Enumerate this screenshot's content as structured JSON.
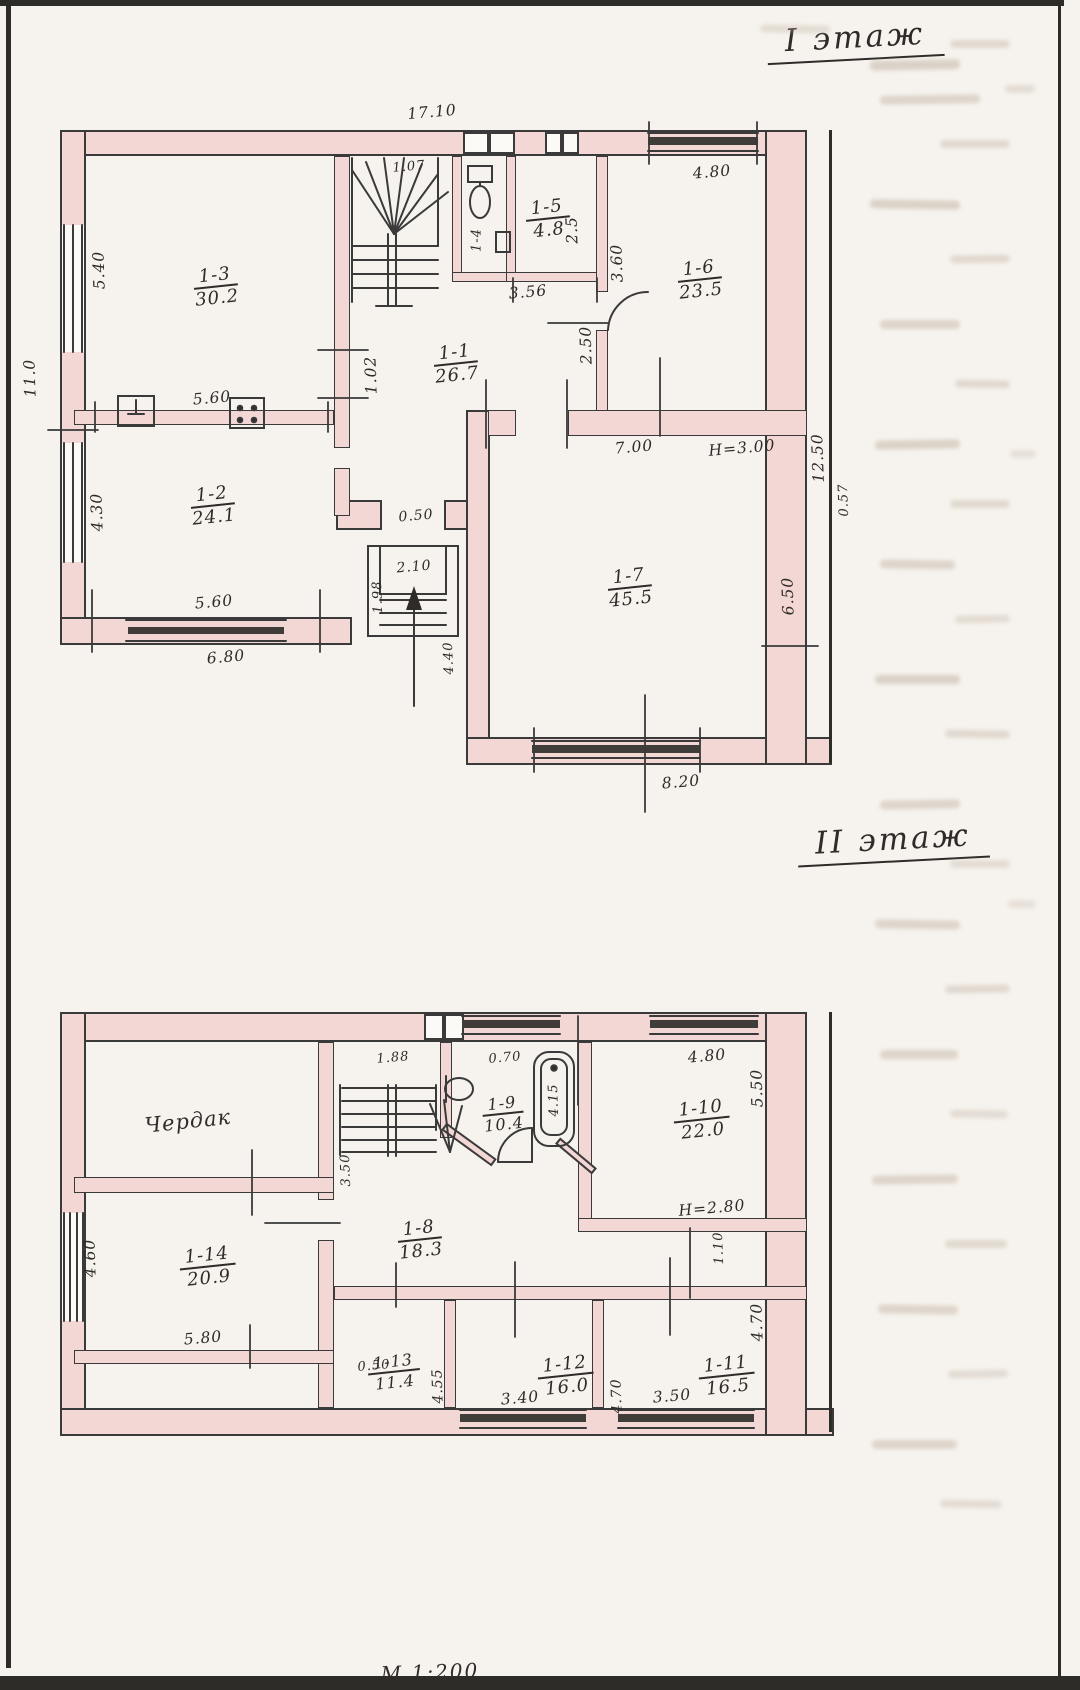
{
  "document": {
    "floor1_title": "I этаж",
    "floor2_title": "II этаж",
    "scale_note": "М 1:200"
  },
  "colors": {
    "paper": "#f6f3ee",
    "ink": "#2e2b28",
    "wall_line": "#3a3a3a",
    "wall_fill": "#f2d7d5",
    "window_dark": "#3f3c39",
    "frame": "#2e2c29"
  },
  "floor1": {
    "rooms": [
      {
        "id": "1-3",
        "area": "30.2"
      },
      {
        "id": "1-2",
        "area": "24.1"
      },
      {
        "id": "1-1",
        "area": "26.7"
      },
      {
        "id": "1-4"
      },
      {
        "id": "1-5",
        "area": "4.8"
      },
      {
        "id": "1-6",
        "area": "23.5"
      },
      {
        "id": "1-7",
        "area": "45.5"
      }
    ],
    "dims": {
      "top_width": "17.10",
      "left_height": "11.0",
      "r3_left": "5.40",
      "r3_bottom": "5.60",
      "r2_left": "4.30",
      "r2_bottom": "5.60",
      "outer_bottom_left": "6.80",
      "hall_left": "1.02",
      "stair_width": "1.07",
      "bath_bottom": "3.56",
      "r6_left_upper": "3.60",
      "r6_left_lower": "2.50",
      "r5_side": "2.5",
      "r6_top": "4.80",
      "r7_top": "7.00",
      "r7_ceiling": "H=3.00",
      "r7_right": "6.50",
      "right_total": "12.50",
      "right_offset": "0.57",
      "porch_step": "0.50",
      "porch_width": "2.10",
      "porch_depth": "1.98",
      "entry_width": "4.40",
      "r7_bottom": "8.20"
    }
  },
  "floor2": {
    "rooms": [
      {
        "name": "Чердак"
      },
      {
        "id": "1-14",
        "area": "20.9"
      },
      {
        "id": "1-8",
        "area": "18.3"
      },
      {
        "id": "1-9",
        "area": "10.4"
      },
      {
        "id": "1-10",
        "area": "22.0"
      },
      {
        "id": "1-13",
        "area": "11.4"
      },
      {
        "id": "1-12",
        "area": "16.0"
      },
      {
        "id": "1-11",
        "area": "16.5"
      }
    ],
    "dims": {
      "stair_top": "1.88",
      "stair_side": "3.50",
      "bath_top": "0.70",
      "tub_length": "4.15",
      "r10_top": "4.80",
      "r10_right": "5.50",
      "r10_ceiling": "H=2.80",
      "corridor": "1.10",
      "r14_left": "4.60",
      "r14_bottom": "5.80",
      "r13_right": "4.55",
      "r12_right": "4.70",
      "r11_right": "4.70",
      "bottom_step": "0.50",
      "r12_bottom": "3.40",
      "r11_bottom": "3.50"
    }
  }
}
